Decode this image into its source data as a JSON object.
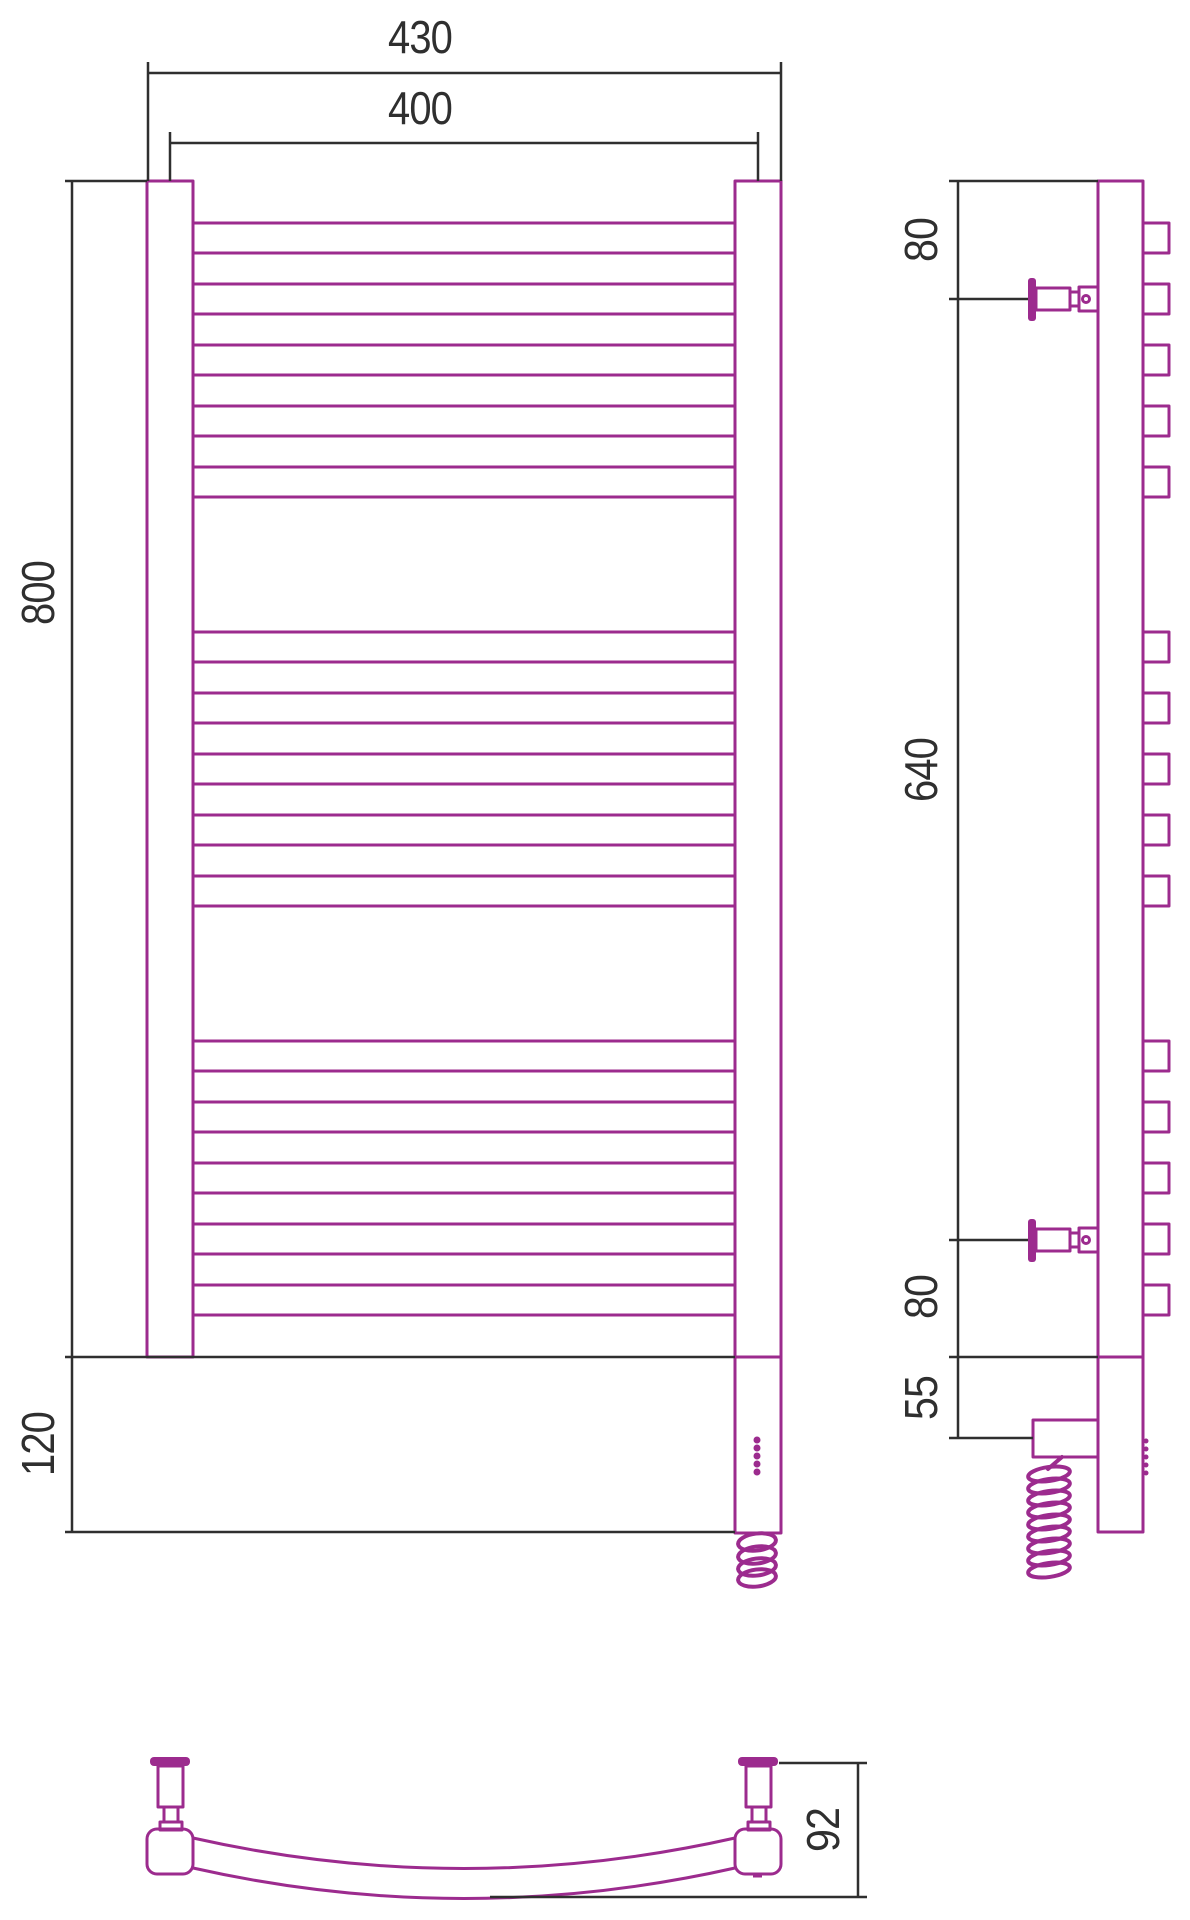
{
  "colors": {
    "accent": "#9c2b8e",
    "line": "#2f2f2f",
    "bg": "#ffffff"
  },
  "labels": {
    "front_outer_width": "430",
    "front_inner_width": "400",
    "front_height": "800",
    "front_bottom_section": "120",
    "side_top_offset": "80",
    "side_mount_span": "640",
    "side_bottom_offset": "80",
    "side_element_offset": "55",
    "bottom_depth": "92"
  },
  "rungs": {
    "rows_y": [
      223,
      284,
      345,
      406,
      467,
      632,
      693,
      754,
      815,
      876,
      1041,
      1102,
      1163,
      1224,
      1285
    ],
    "tube_height": 30,
    "front": {
      "x": 193,
      "width": 542
    },
    "side": {
      "x": 1143,
      "width": 26
    }
  },
  "indicator_dots": {
    "front": {
      "x": 757,
      "y_start": 1440,
      "step": 8,
      "count": 5,
      "r": 3.5
    },
    "side": {
      "x": 1146,
      "y_start": 1441,
      "step": 8,
      "count": 5,
      "r": 2.5
    }
  }
}
